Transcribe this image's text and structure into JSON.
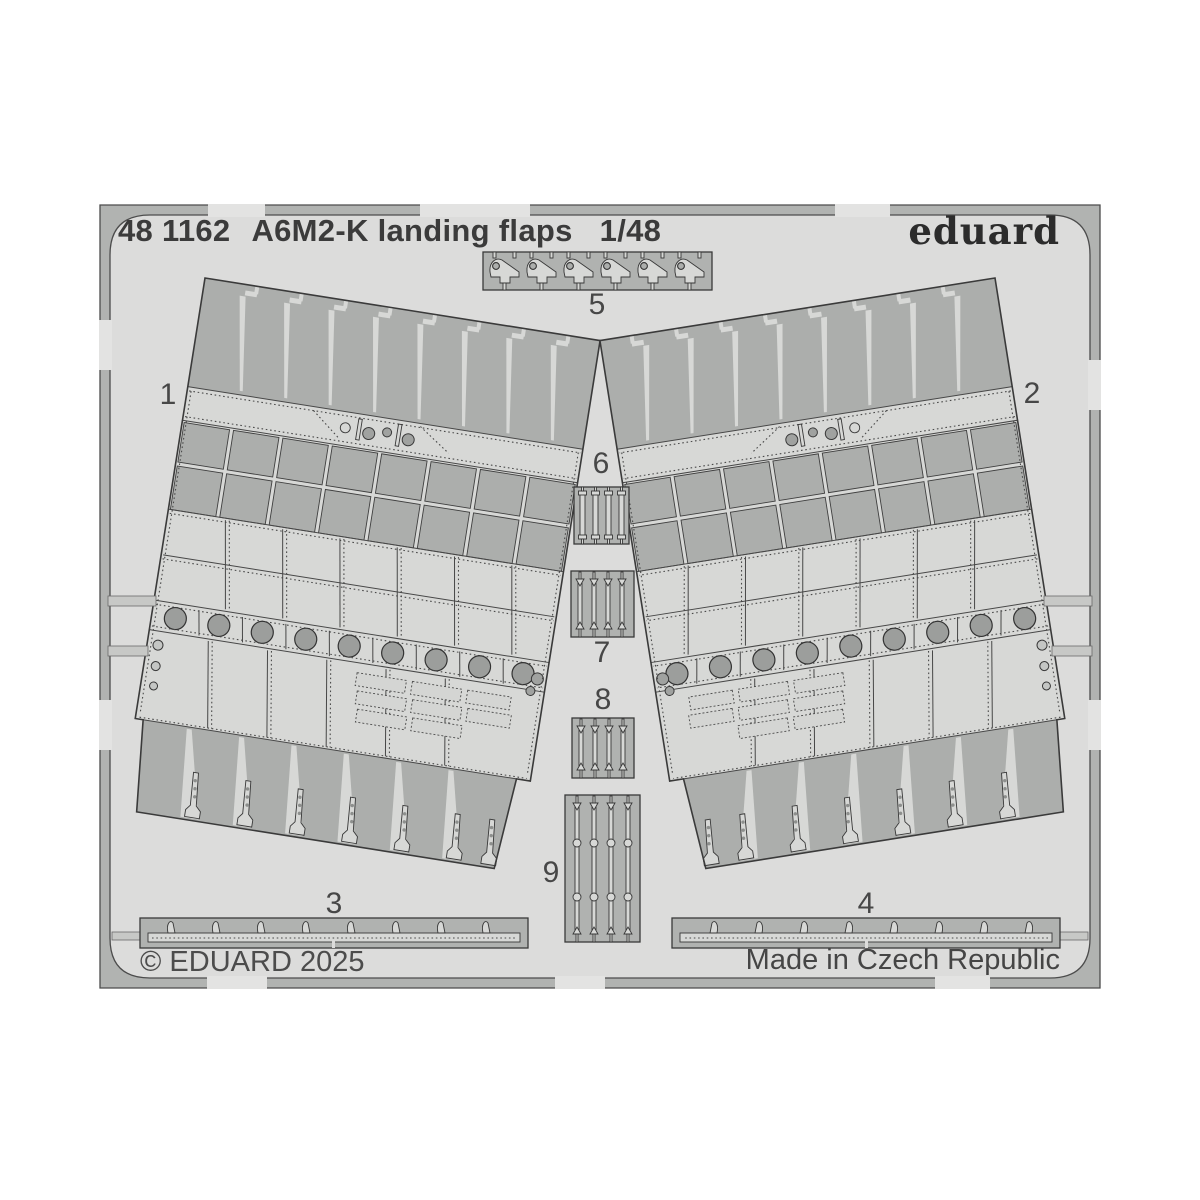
{
  "sheet": {
    "catalog_number": "48 1162",
    "title": "A6M2-K landing flaps",
    "scale": "1/48",
    "brand": "eduard",
    "copyright": "© EDUARD 2025",
    "made_in": "Made in Czech Republic",
    "part_labels": {
      "p1": "1",
      "p2": "2",
      "p3": "3",
      "p4": "4",
      "p5": "5",
      "p6": "6",
      "p7": "7",
      "p8": "8",
      "p9": "9"
    },
    "colors": {
      "page_background": "#ffffff",
      "plate_background": "#dcdcdb",
      "fret_metal": "#b0b2b0",
      "etched_light": "#d7d8d6",
      "outline": "#3a3a3a"
    }
  }
}
